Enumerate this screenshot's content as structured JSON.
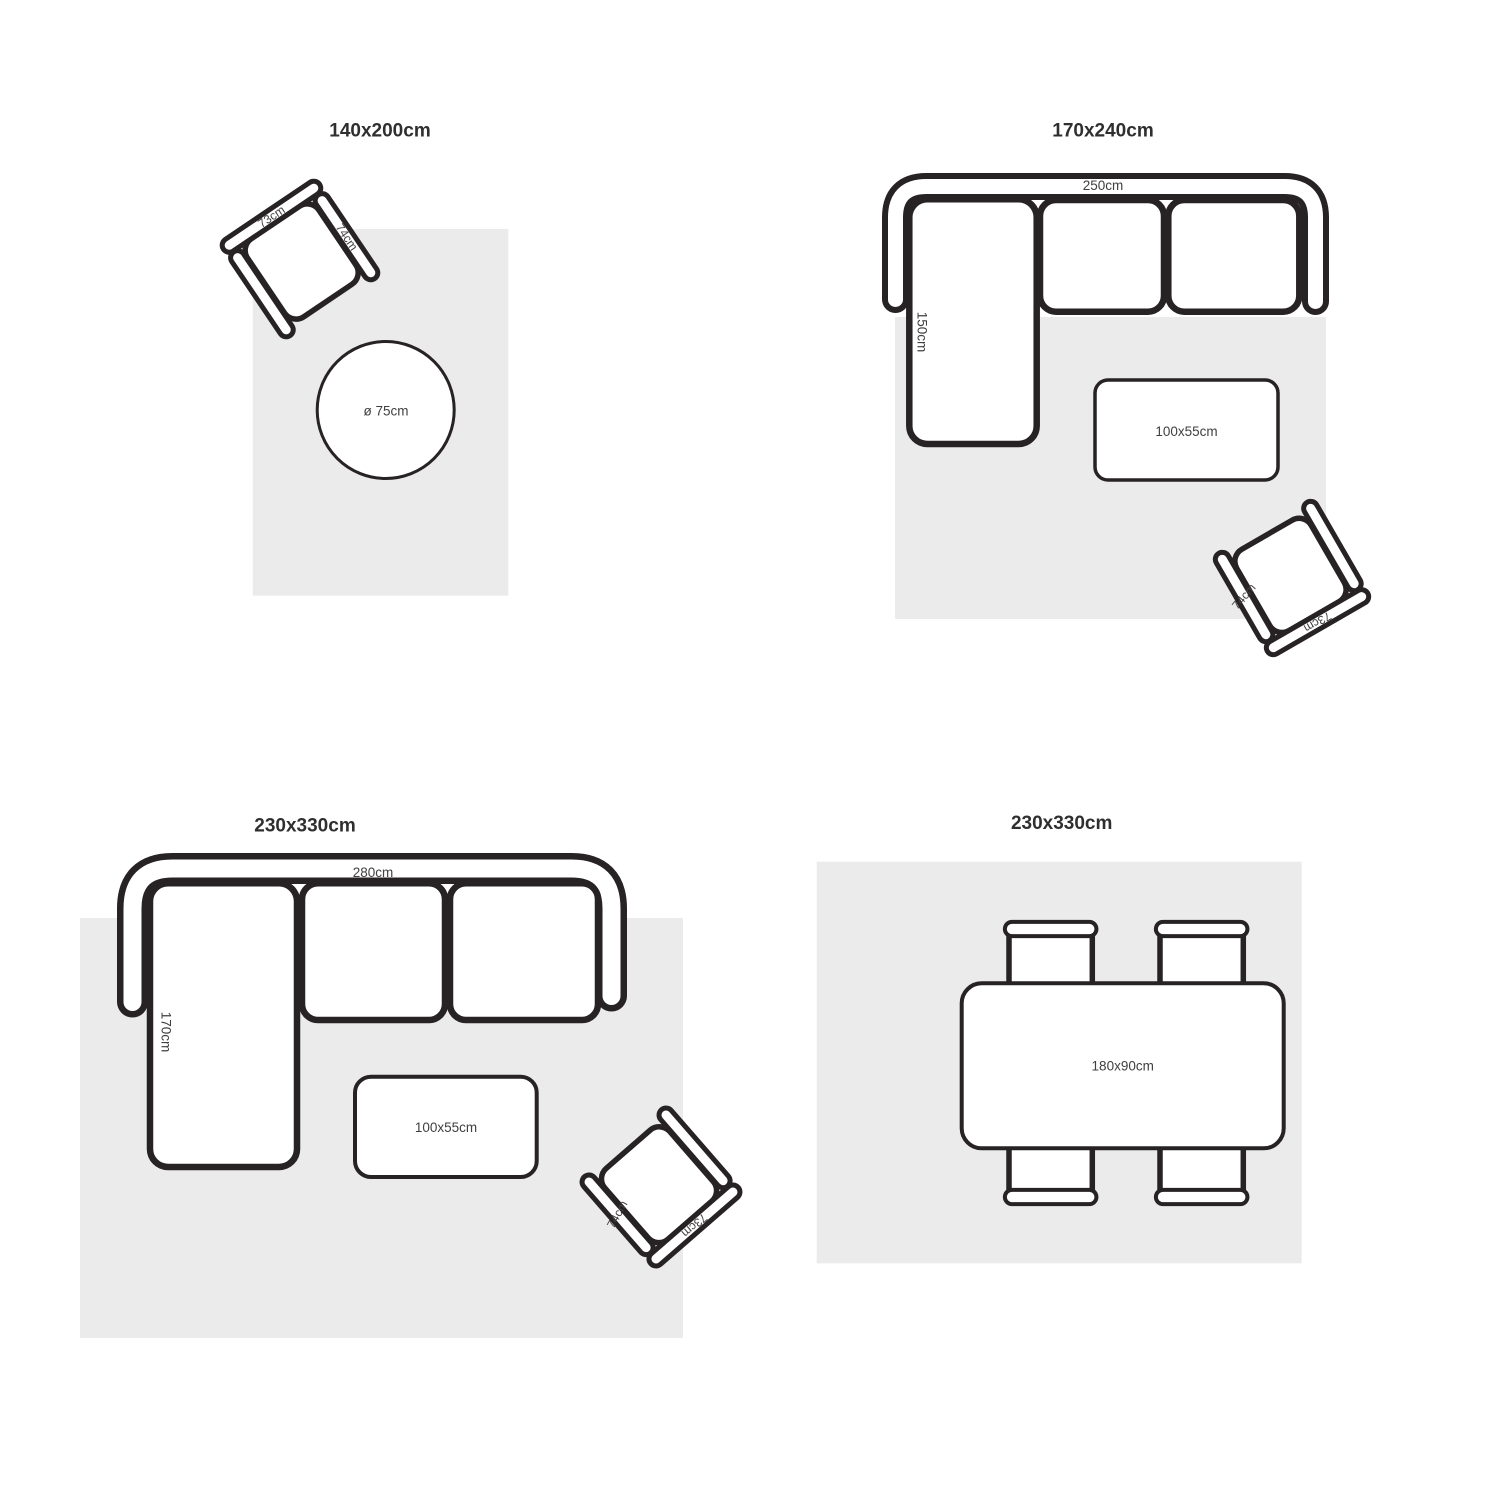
{
  "colors": {
    "background": "#ffffff",
    "ink": "#272223",
    "rug": "#ebebeb",
    "label": "#404040",
    "title": "#2f2f2f"
  },
  "panels": {
    "p1": {
      "title": "140x200cm",
      "chair_back": "73cm",
      "chair_arm": "74cm",
      "round_table": "ø 75cm"
    },
    "p2": {
      "title": "170x240cm",
      "sofa_width": "250cm",
      "sofa_depth": "150cm",
      "coffee_table": "100x55cm",
      "chair_back": "73cm",
      "chair_arm": "74cm"
    },
    "p3": {
      "title": "230x330cm",
      "sofa_width": "280cm",
      "sofa_depth": "170cm",
      "coffee_table": "100x55cm",
      "chair_back": "73cm",
      "chair_arm": "74cm"
    },
    "p4": {
      "title": "230x330cm",
      "dining_table": "180x90cm"
    }
  }
}
